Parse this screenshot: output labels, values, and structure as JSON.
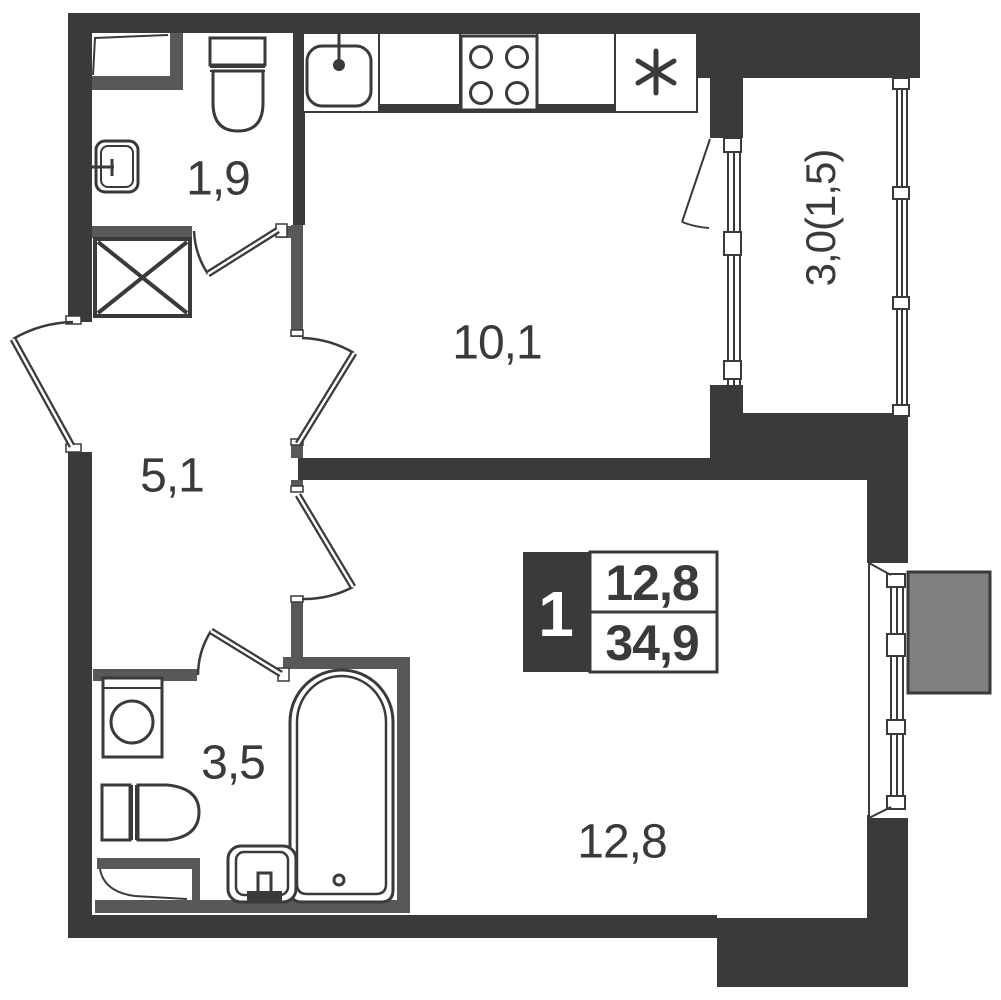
{
  "rooms": {
    "wc": {
      "label": "1,9"
    },
    "kitchen": {
      "label": "10,1"
    },
    "hallway": {
      "label": "5,1"
    },
    "bathroom": {
      "label": "3,5"
    },
    "living_room": {
      "label": "12,8"
    },
    "balcony": {
      "label": "3,0(1,5)"
    }
  },
  "info_badge": {
    "rooms_count": "1",
    "living_area": "12,8",
    "total_area": "34,9"
  },
  "icons": {
    "fridge_icon": "six-ray asterisk"
  },
  "colors": {
    "wall_structural": "#3a3a3c",
    "wall_partition": "#58585b",
    "adjacent_structure": "#7f7f82",
    "background": "#ffffff",
    "label_text": "#3a3a3c"
  }
}
